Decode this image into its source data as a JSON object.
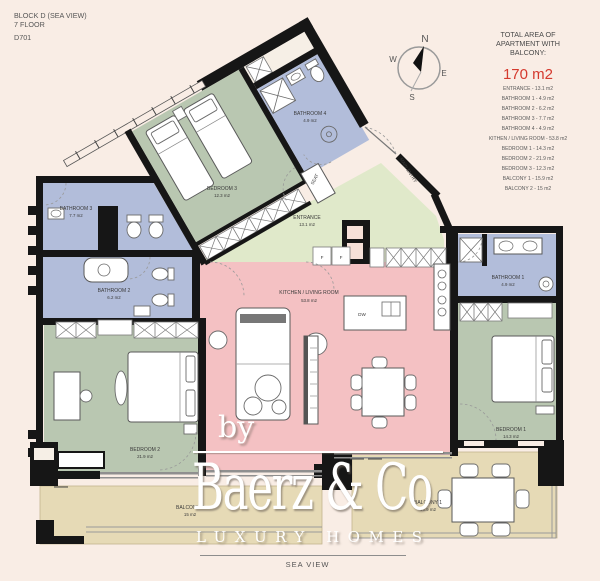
{
  "header": {
    "line1": "BLOCK D (SEA VIEW)",
    "line2": "7 FLOOR",
    "unit": "D701"
  },
  "compass": {
    "n": "N",
    "e": "E",
    "s": "S",
    "w": "W"
  },
  "legend": {
    "title_lines": [
      "TOTAL AREA OF",
      "APARTMENT WITH",
      "BALCONY:"
    ],
    "total": "170 m2",
    "items": [
      "ENTRANCE - 13.1 m2",
      "BATHROOM 1 - 4.9 m2",
      "BATHROOM 2 - 6.2 m2",
      "BATHROOM 3 - 7.7 m2",
      "BATHROOM 4 - 4.9 m2",
      "KITHEN / LIVING ROOM - 53.8 m2",
      "BEDROOM 1 - 14.3 m2",
      "BEDROOM 2 - 21.9 m2",
      "BEDROOM 3 - 12.3 m2",
      "BALCONY 1 - 15.9 m2",
      "BALCONY 2 - 15 m2"
    ]
  },
  "rooms": {
    "entrance": {
      "name": "ENTRANCE",
      "area": "13.1 m2"
    },
    "kitchen": {
      "name": "KITCHEN / LIVING ROOM",
      "area": "53.8 m2"
    },
    "bedroom1": {
      "name": "BEDROOM 1",
      "area": "14.3 m2"
    },
    "bedroom2": {
      "name": "BEDROOM 2",
      "area": "21.9 m2"
    },
    "bedroom3": {
      "name": "BEDROOM 3",
      "area": "12.3 m2"
    },
    "bathroom1": {
      "name": "BATHROOM 1",
      "area": "4.9 m2"
    },
    "bathroom2": {
      "name": "BATHROOM 2",
      "area": "6.2 m2"
    },
    "bathroom3": {
      "name": "BATHROOM 3",
      "area": "7.7 m2"
    },
    "bathroom4": {
      "name": "BATHROOM 4",
      "area": "4.9 m2"
    },
    "balcony1": {
      "name": "BALCONY 1",
      "area": "15.9 m2"
    },
    "balcony2": {
      "name": "BALCONY 2",
      "area": "15 m2"
    }
  },
  "plan_labels": {
    "seat": "SEAT",
    "main_entry": "MAIN ENTRY",
    "dw": "DW",
    "f": "F",
    "sea_view": "SEA VIEW"
  },
  "watermark": {
    "by": "by",
    "brand": "Baerz & Co",
    "tagline": "LUXURY HOMES"
  },
  "colors": {
    "background": "#f9ede5",
    "bedroom": "#b9c7b1",
    "bathroom": "#b2bdda",
    "living": "#f4c1c3",
    "entrance": "#e0e9ca",
    "balcony": "#e6dab6",
    "wall": "#161616",
    "accent_red": "#d53a2e"
  }
}
